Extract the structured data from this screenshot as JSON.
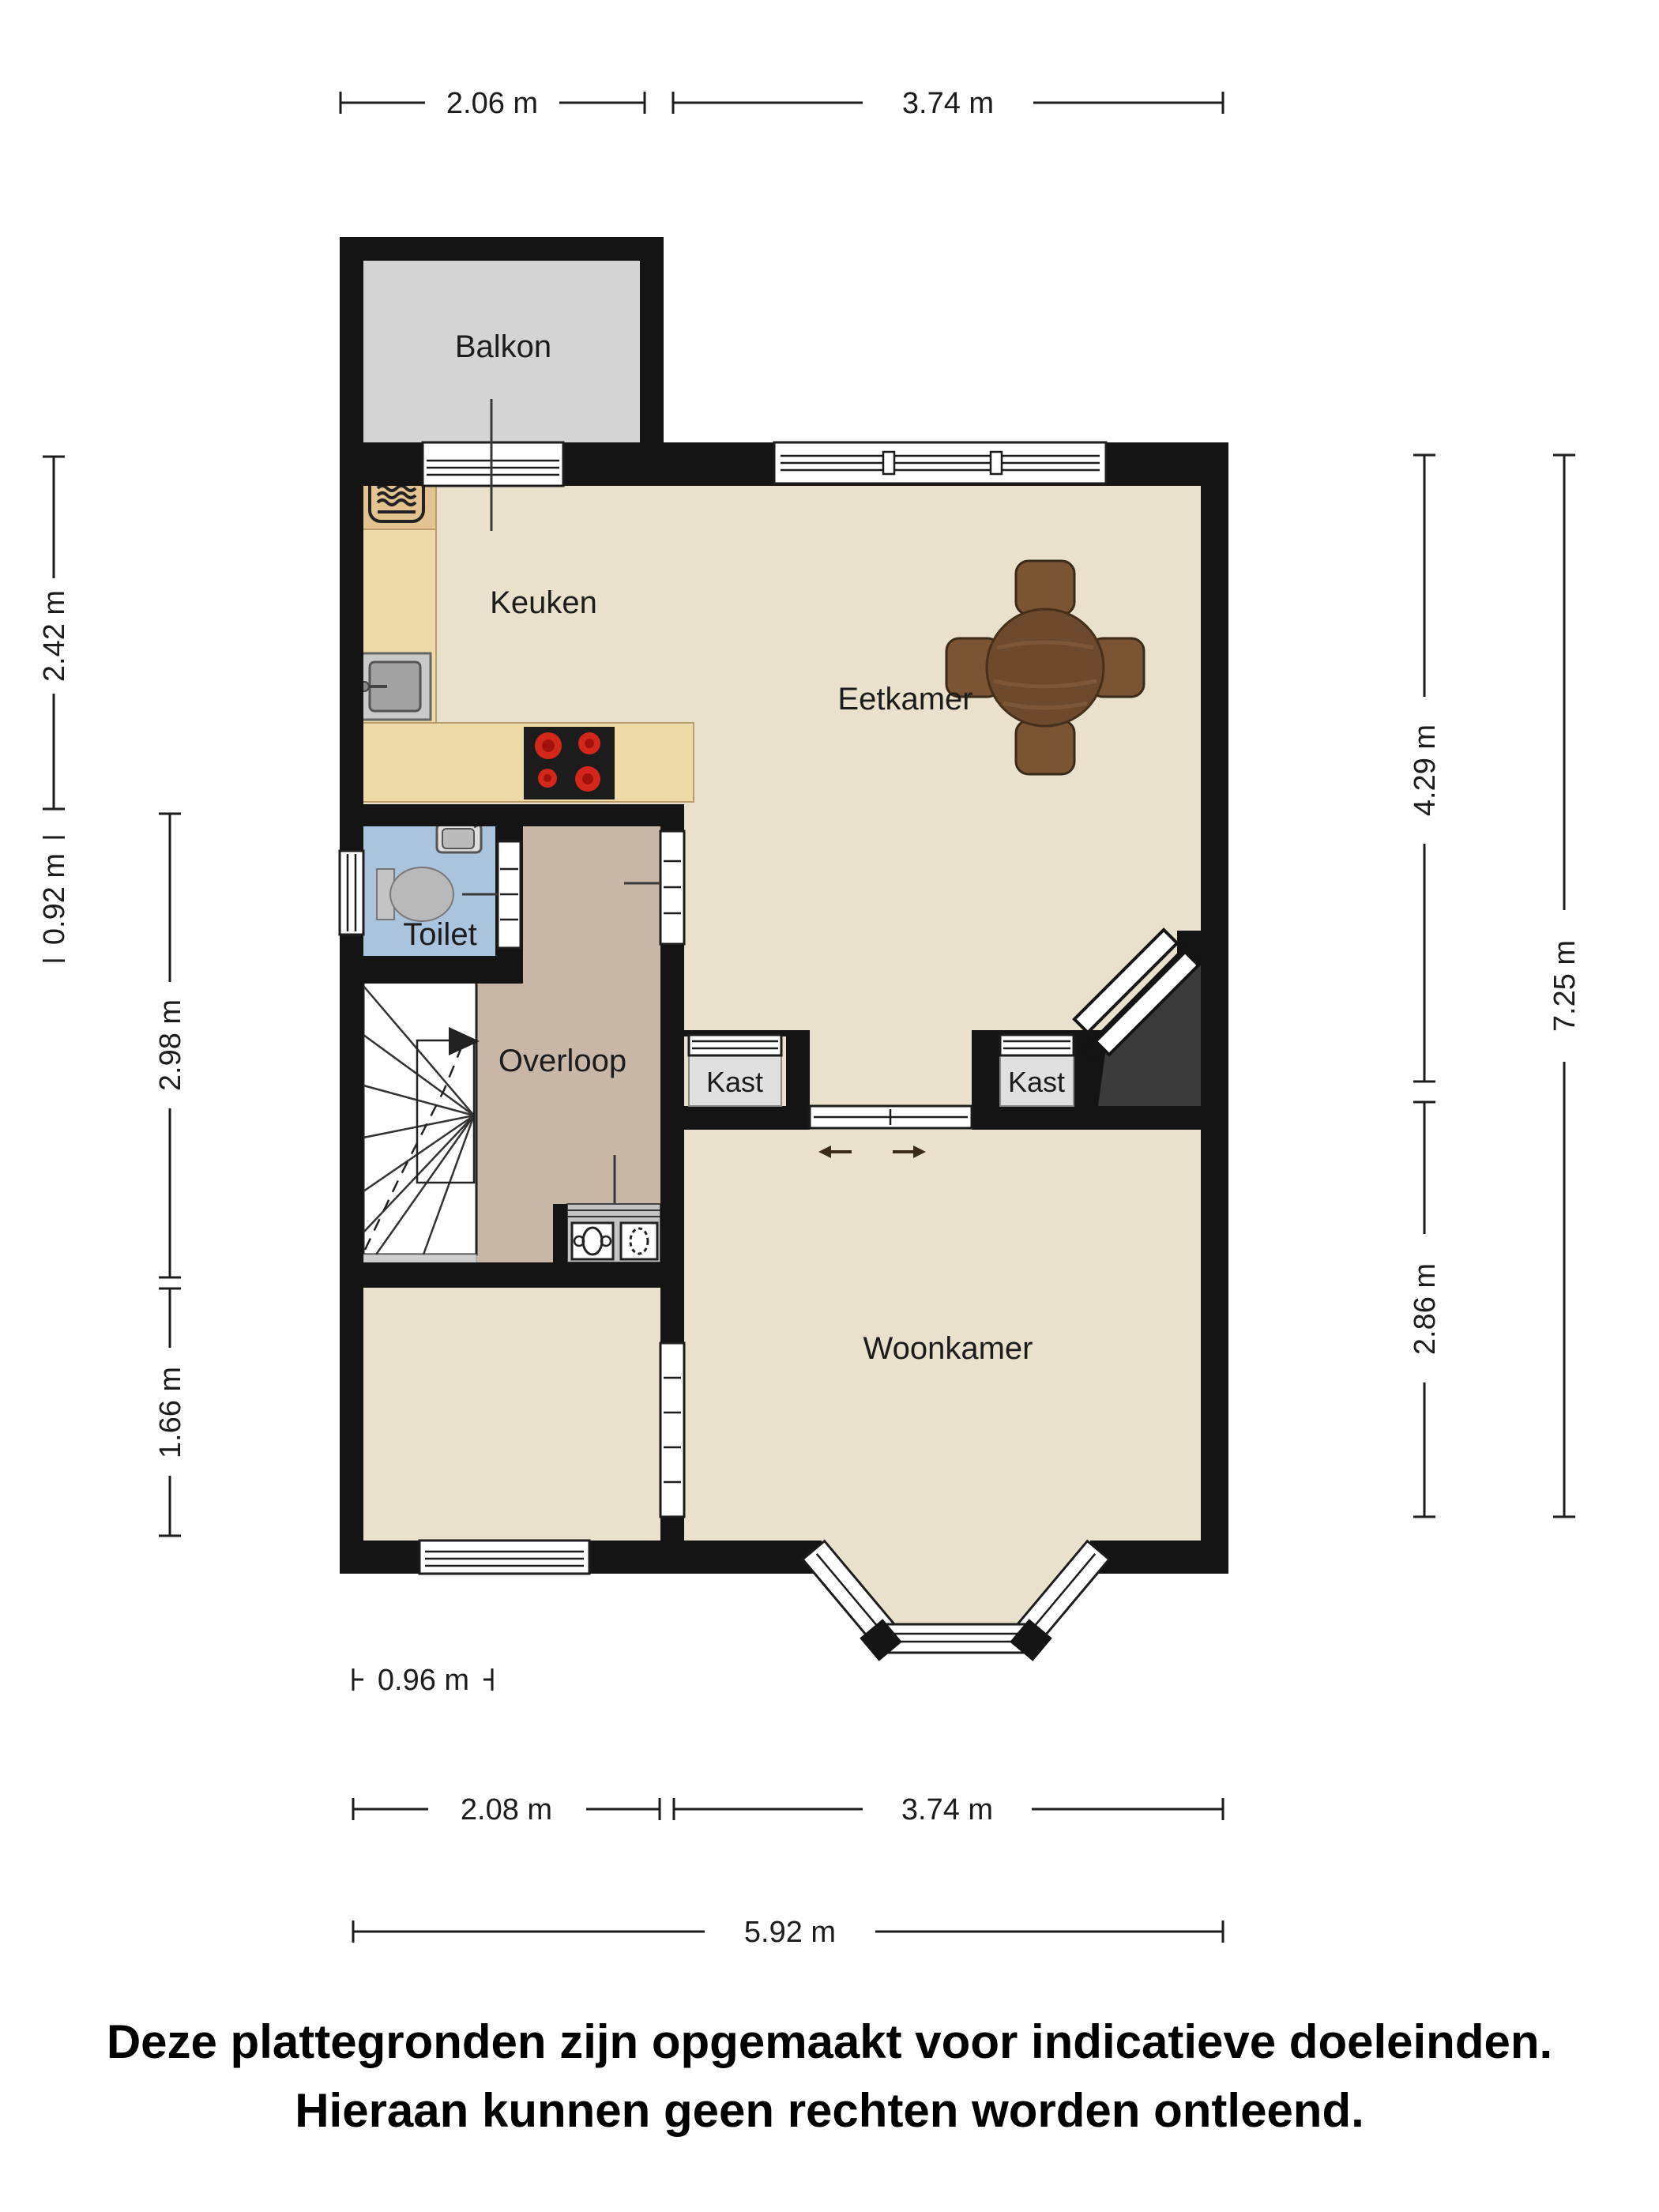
{
  "title": "Floor plan (plattegrond) – first floor with balcony",
  "labels": {
    "balkon": "Balkon",
    "keuken": "Keuken",
    "eetkamer": "Eetkamer",
    "toilet": "Toilet",
    "overloop": "Overloop",
    "kast_left": "Kast",
    "kast_right": "Kast",
    "woonkamer": "Woonkamer"
  },
  "dims": {
    "top_left": "2.06 m",
    "top_right": "3.74 m",
    "left_keuken": "2.42 m",
    "left_toilet": "0.92 m",
    "left_overloop": "2.98 m",
    "left_room": "1.66 m",
    "right_eetkamer": "4.29 m",
    "right_woonkamer": "2.86 m",
    "right_total": "7.25 m",
    "bottom_window": "0.96 m",
    "bottom_left": "2.08 m",
    "bottom_right": "3.74 m",
    "bottom_total": "5.92 m"
  },
  "disclaimer": {
    "line1": "Deze plattegronden zijn opgemaakt voor indicatieve doeleinden.",
    "line2": "Hieraan kunnen geen rechten worden ontleend."
  },
  "colors": {
    "wall": "#141414",
    "floor_main": "#e9e1cb",
    "floor_overloop": "#c8b7a7",
    "floor_balkon": "#d4d4d4",
    "floor_toilet": "#abc4de",
    "counter_wood": "#eed9a9",
    "counter_wood_dark": "#e3c491",
    "burner_red": "#d3271b",
    "void_dark": "#3b3b3b",
    "table_brown": "#6d4a2d",
    "chair_brown": "#7b5434",
    "kast_fill": "#e0e0e0"
  }
}
